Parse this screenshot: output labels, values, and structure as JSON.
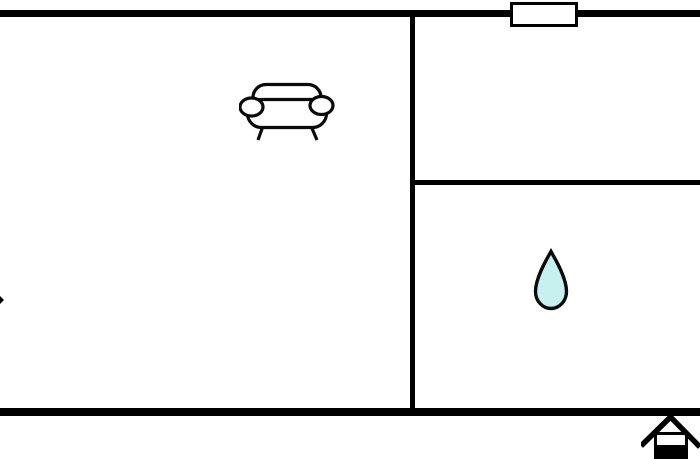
{
  "floorplan": {
    "background_color": "#ffffff",
    "wall_color": "#000000",
    "line_color": "#0a0a0a",
    "water_drop_fill": "#c7f1ef",
    "window_fill": "#ffffff",
    "house_fill": "#000000",
    "icons": {
      "sofa": "sofa-icon",
      "water_drop": "water-drop-icon",
      "window": "window-symbol",
      "home": "home-icon",
      "left_edge_mark": "left-edge-mark"
    }
  }
}
